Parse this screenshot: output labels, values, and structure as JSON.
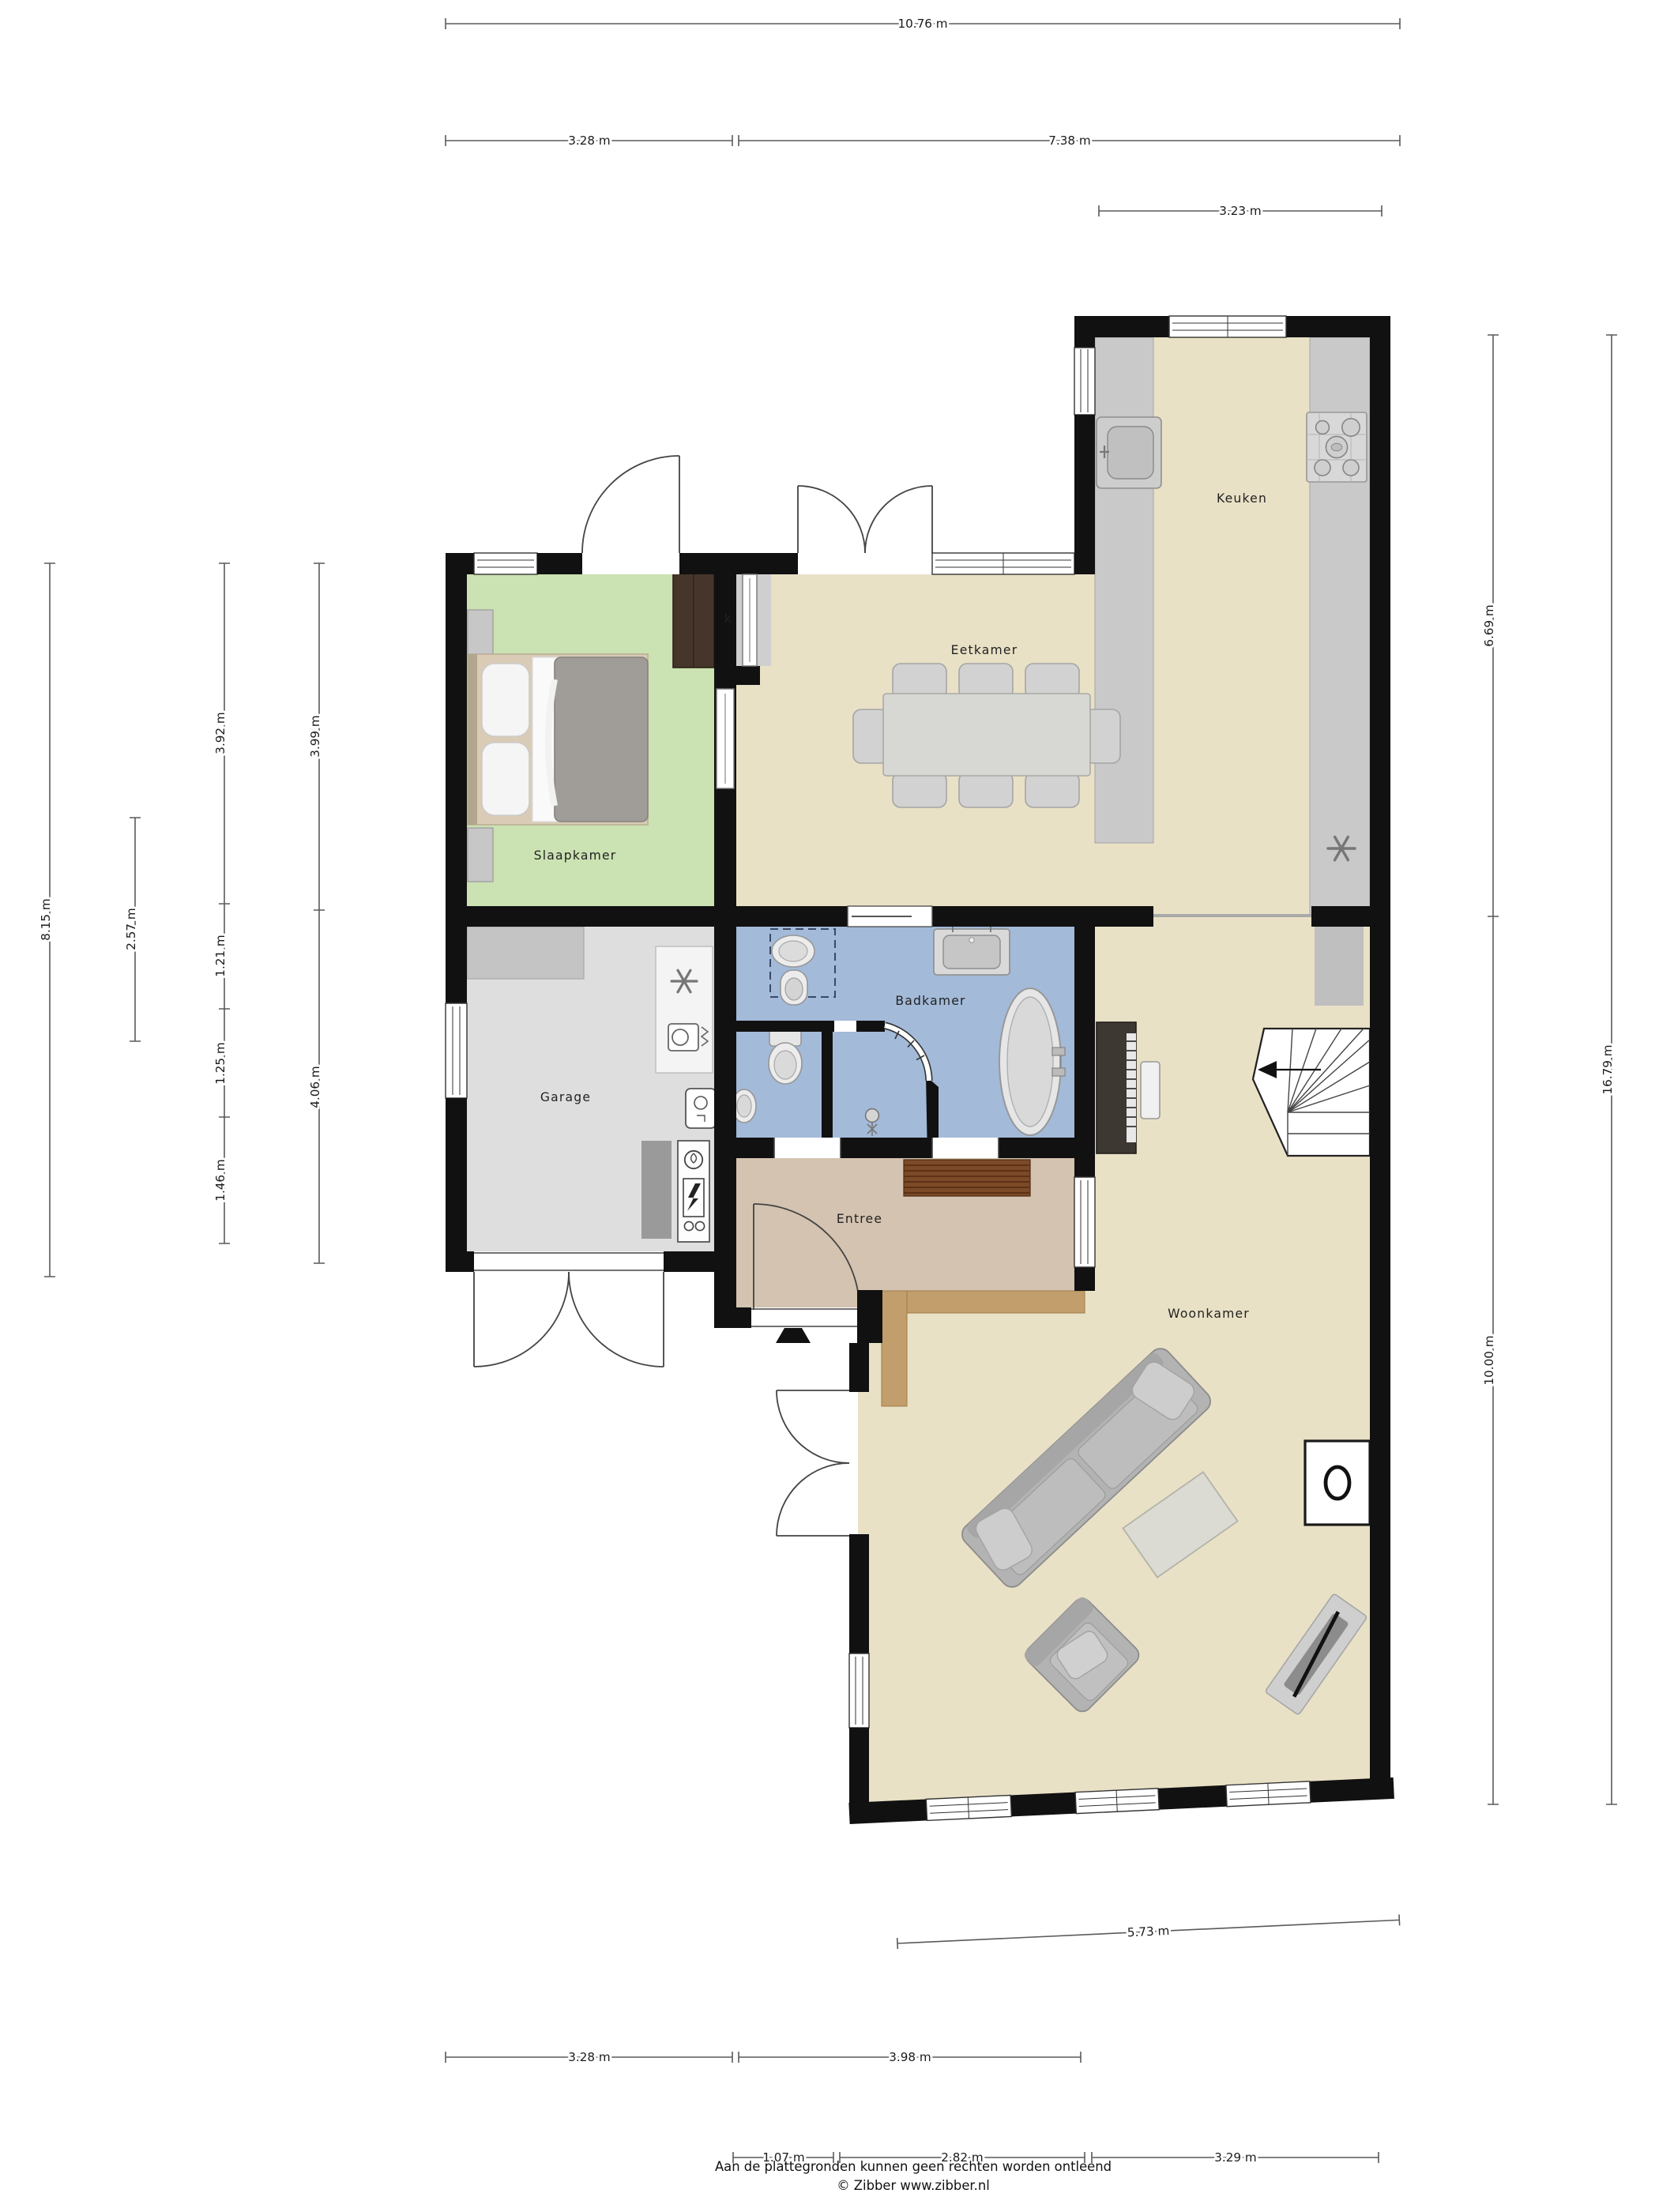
{
  "plan": {
    "type": "floorplan",
    "source_footer": {
      "line1": "Aan de plattegronden kunnen geen rechten worden ontleend",
      "line2": "© Zibber www.zibber.nl"
    },
    "rooms": {
      "keuken": {
        "label": "Keuken"
      },
      "eetkamer": {
        "label": "Eetkamer"
      },
      "slaapkamer": {
        "label": "Slaapkamer"
      },
      "garage": {
        "label": "Garage"
      },
      "badkamer": {
        "label": "Badkamer"
      },
      "entree": {
        "label": "Entree"
      },
      "woonkamer": {
        "label": "Woonkamer"
      },
      "closet": {
        "label": "k"
      }
    },
    "dimensions": {
      "top_total": "10.76 m",
      "top_left": "3.28 m",
      "top_right": "7.38 m",
      "top_kitchen": "3.23 m",
      "left_total": "8.15 m",
      "left_mid": "2.57 m",
      "left_a": "3.92 m",
      "left_b": "1.21 m",
      "left_c": "1.25 m",
      "left_d": "1.46 m",
      "left_e": "3.99 m",
      "left_f": "4.06 m",
      "right_top": "6.69 m",
      "right_total": "16.79 m",
      "right_bottom": "10.00 m",
      "bottom_living": "5.73 m",
      "bottom_left": "3.28 m",
      "bottom_mid": "3.98 m",
      "bottom_e1": "1.07 m",
      "bottom_e2": "2.82 m",
      "bottom_e3": "3.29 m"
    },
    "colors": {
      "wall": "#111111",
      "floor_main": "#e9e1c6",
      "floor_bedroom": "#cbe2b2",
      "floor_bathroom": "#a3bad9",
      "floor_garage": "#dedede",
      "floor_entry": "#d4c3b0",
      "wood_threshold": "#c19e6b"
    }
  }
}
